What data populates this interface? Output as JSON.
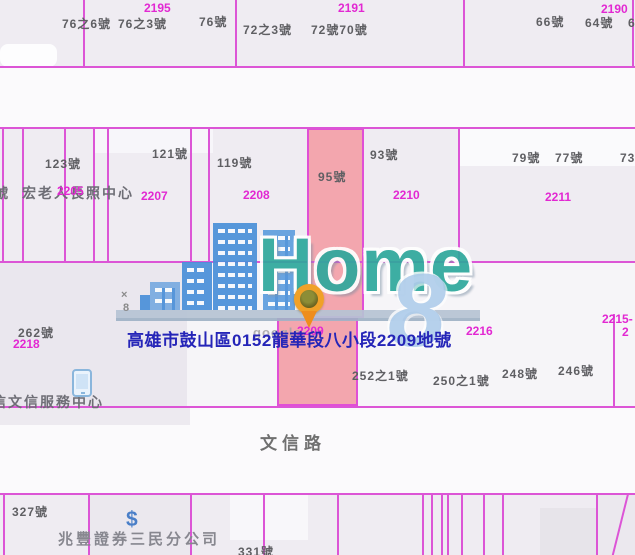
{
  "watermark": {
    "brand": "Home",
    "badge": "8"
  },
  "map": {
    "background": "#efecf2",
    "boundary_color": "#dc55d6",
    "highlight_fill": "#f3a6ae",
    "address_text": "高雄市鼓山區0152龍華段八小段2209地號",
    "road_name": "文信路",
    "highlighted_parcel_number": "2209",
    "regions": [
      {
        "x": 0,
        "y": 66,
        "w": 635,
        "h": 61,
        "c": "#fbfafc",
        "n": "road-area-top"
      },
      {
        "x": 0,
        "y": 261,
        "w": 635,
        "h": 146,
        "c": "#f6f5f8",
        "n": "block-middle"
      },
      {
        "x": 0,
        "y": 261,
        "w": 187,
        "h": 146,
        "c": "#eae7ee",
        "n": "block-middle-left"
      },
      {
        "x": 0,
        "y": 407,
        "w": 635,
        "h": 86,
        "c": "#fbfafc",
        "n": "road-area-wenxin"
      },
      {
        "x": 0,
        "y": 407,
        "w": 190,
        "h": 18,
        "c": "#edeaf0",
        "n": "strip-left"
      },
      {
        "x": 95,
        "y": 129,
        "w": 118,
        "h": 24,
        "c": "#f7f6fa",
        "n": "building-footprint"
      },
      {
        "x": 459,
        "y": 128,
        "w": 176,
        "h": 38,
        "c": "#fafafc",
        "n": "building-footprint"
      },
      {
        "x": 0,
        "y": 44,
        "w": 57,
        "h": 23,
        "c": "#fdfdfe",
        "r": 8,
        "n": "building-footprint"
      },
      {
        "x": 230,
        "y": 495,
        "w": 78,
        "h": 45,
        "c": "#f8f7fa",
        "n": "building-footprint"
      },
      {
        "x": 540,
        "y": 508,
        "w": 80,
        "h": 47,
        "c": "#e7e4ea",
        "n": "building-footprint"
      },
      {
        "x": 88,
        "y": 495,
        "w": 102,
        "h": 60,
        "c": "#ebe8ee",
        "n": "building-footprint"
      },
      {
        "x": 596,
        "y": 495,
        "w": 39,
        "h": 60,
        "c": "#ebe8ee",
        "n": "building-footprint"
      }
    ],
    "highlight_parcels": [
      {
        "x": 307,
        "y": 128,
        "w": 57,
        "h": 190,
        "n": "highlighted-parcel-upper"
      },
      {
        "x": 277,
        "y": 318,
        "w": 81,
        "h": 88,
        "n": "highlighted-parcel-lower"
      }
    ],
    "boundaries": [
      {
        "x": 0,
        "y": 66,
        "w": 635,
        "h": 2
      },
      {
        "x": 0,
        "y": 127,
        "w": 635,
        "h": 2
      },
      {
        "x": 0,
        "y": 261,
        "w": 635,
        "h": 2
      },
      {
        "x": 0,
        "y": 406,
        "w": 635,
        "h": 2
      },
      {
        "x": 0,
        "y": 493,
        "w": 635,
        "h": 2
      },
      {
        "x": 83,
        "y": 0,
        "w": 2,
        "h": 67
      },
      {
        "x": 235,
        "y": 0,
        "w": 2,
        "h": 67
      },
      {
        "x": 463,
        "y": 0,
        "w": 2,
        "h": 67
      },
      {
        "x": 632,
        "y": 0,
        "w": 2,
        "h": 67
      },
      {
        "x": 2,
        "y": 128,
        "w": 2,
        "h": 134
      },
      {
        "x": 22,
        "y": 128,
        "w": 2,
        "h": 134
      },
      {
        "x": 64,
        "y": 128,
        "w": 2,
        "h": 134
      },
      {
        "x": 93,
        "y": 128,
        "w": 2,
        "h": 134
      },
      {
        "x": 107,
        "y": 128,
        "w": 2,
        "h": 134
      },
      {
        "x": 190,
        "y": 128,
        "w": 2,
        "h": 134
      },
      {
        "x": 208,
        "y": 128,
        "w": 2,
        "h": 134
      },
      {
        "x": 458,
        "y": 128,
        "w": 2,
        "h": 134
      },
      {
        "x": 613,
        "y": 314,
        "w": 2,
        "h": 93
      },
      {
        "x": 3,
        "y": 494,
        "w": 2,
        "h": 61
      },
      {
        "x": 88,
        "y": 494,
        "w": 2,
        "h": 61
      },
      {
        "x": 190,
        "y": 494,
        "w": 2,
        "h": 61
      },
      {
        "x": 263,
        "y": 494,
        "w": 2,
        "h": 61
      },
      {
        "x": 337,
        "y": 494,
        "w": 2,
        "h": 61
      },
      {
        "x": 422,
        "y": 494,
        "w": 2,
        "h": 61
      },
      {
        "x": 431,
        "y": 494,
        "w": 2,
        "h": 61
      },
      {
        "x": 441,
        "y": 494,
        "w": 2,
        "h": 61
      },
      {
        "x": 447,
        "y": 494,
        "w": 2,
        "h": 61
      },
      {
        "x": 461,
        "y": 494,
        "w": 2,
        "h": 61
      },
      {
        "x": 483,
        "y": 494,
        "w": 2,
        "h": 61
      },
      {
        "x": 502,
        "y": 494,
        "w": 2,
        "h": 61
      },
      {
        "x": 596,
        "y": 494,
        "w": 2,
        "h": 61
      },
      {
        "x": 627,
        "y": 494,
        "w": 2,
        "h": 64,
        "rot": 14
      }
    ],
    "labels": [
      {
        "t": "76之6號",
        "x": 62,
        "y": 18,
        "cls": "h",
        "n": "house-number-label"
      },
      {
        "t": "76之3號",
        "x": 118,
        "y": 18,
        "cls": "h",
        "n": "house-number-label"
      },
      {
        "t": "76號",
        "x": 199,
        "y": 16,
        "cls": "h",
        "n": "house-number-label"
      },
      {
        "t": "72之3號",
        "x": 243,
        "y": 24,
        "cls": "h",
        "n": "house-number-label"
      },
      {
        "t": "72號70號",
        "x": 311,
        "y": 24,
        "cls": "h",
        "n": "house-number-label"
      },
      {
        "t": "66號",
        "x": 536,
        "y": 16,
        "cls": "h",
        "n": "house-number-label"
      },
      {
        "t": "64號",
        "x": 585,
        "y": 17,
        "cls": "h",
        "n": "house-number-label"
      },
      {
        "t": "62號",
        "x": 628,
        "y": 17,
        "cls": "h",
        "n": "house-number-label"
      },
      {
        "t": "2195",
        "x": 144,
        "y": 2,
        "cls": "p",
        "n": "parcel-number-label"
      },
      {
        "t": "2191",
        "x": 338,
        "y": 2,
        "cls": "p",
        "n": "parcel-number-label"
      },
      {
        "t": "2190",
        "x": 601,
        "y": 3,
        "cls": "p",
        "n": "parcel-number-label"
      },
      {
        "t": "123號",
        "x": 45,
        "y": 158,
        "cls": "h",
        "n": "house-number-label"
      },
      {
        "t": "121號",
        "x": 152,
        "y": 148,
        "cls": "h",
        "n": "house-number-label"
      },
      {
        "t": "119號",
        "x": 217,
        "y": 157,
        "cls": "h",
        "n": "house-number-label"
      },
      {
        "t": "95號",
        "x": 318,
        "y": 171,
        "cls": "h",
        "n": "house-number-label"
      },
      {
        "t": "93號",
        "x": 370,
        "y": 149,
        "cls": "h",
        "n": "house-number-label"
      },
      {
        "t": "79號",
        "x": 512,
        "y": 152,
        "cls": "h",
        "n": "house-number-label"
      },
      {
        "t": "77號",
        "x": 555,
        "y": 152,
        "cls": "h",
        "n": "house-number-label"
      },
      {
        "t": "73號",
        "x": 620,
        "y": 152,
        "cls": "h",
        "n": "house-number-label"
      },
      {
        "t": "號",
        "x": -6,
        "y": 186,
        "cls": "poi",
        "n": "poi-label"
      },
      {
        "t": "宏老人長照中心",
        "x": 22,
        "y": 186,
        "cls": "poi",
        "n": "poi-label"
      },
      {
        "t": "2205",
        "x": 57,
        "y": 185,
        "cls": "p",
        "n": "parcel-number-label"
      },
      {
        "t": "2207",
        "x": 141,
        "y": 190,
        "cls": "p",
        "n": "parcel-number-label"
      },
      {
        "t": "2208",
        "x": 243,
        "y": 189,
        "cls": "p",
        "n": "parcel-number-label"
      },
      {
        "t": "2210",
        "x": 393,
        "y": 189,
        "cls": "p",
        "n": "parcel-number-label"
      },
      {
        "t": "2211",
        "x": 545,
        "y": 191,
        "cls": "p",
        "n": "parcel-number-label"
      },
      {
        "t": "×",
        "x": 121,
        "y": 289,
        "cls": "tiny",
        "n": "map-annotation"
      },
      {
        "t": "8",
        "x": 123,
        "y": 302,
        "cls": "tiny",
        "n": "map-annotation"
      },
      {
        "t": "262號",
        "x": 18,
        "y": 327,
        "cls": "h",
        "n": "house-number-label"
      },
      {
        "t": "2218",
        "x": 13,
        "y": 338,
        "cls": "p",
        "n": "parcel-number-label"
      },
      {
        "t": "google",
        "x": 253,
        "y": 326,
        "cls": "google",
        "n": "attribution-label"
      },
      {
        "t": "2209",
        "x": 297,
        "y": 325,
        "cls": "p",
        "n": "parcel-number-label"
      },
      {
        "t": "2216",
        "x": 466,
        "y": 325,
        "cls": "p",
        "n": "parcel-number-label"
      },
      {
        "t": "2215-",
        "x": 602,
        "y": 313,
        "cls": "p",
        "n": "parcel-number-label"
      },
      {
        "t": "2",
        "x": 622,
        "y": 326,
        "cls": "p",
        "n": "parcel-number-label"
      },
      {
        "t": "高雄市鼓山區0152龍華段八小段2209地號",
        "x": 127,
        "y": 332,
        "cls": "addr",
        "n": "parcel-address-label"
      },
      {
        "t": "252之1號",
        "x": 352,
        "y": 370,
        "cls": "h",
        "n": "house-number-label"
      },
      {
        "t": "250之1號",
        "x": 433,
        "y": 375,
        "cls": "h",
        "n": "house-number-label"
      },
      {
        "t": "248號",
        "x": 502,
        "y": 368,
        "cls": "h",
        "n": "house-number-label"
      },
      {
        "t": "246號",
        "x": 558,
        "y": 365,
        "cls": "h",
        "n": "house-number-label"
      },
      {
        "t": "信文信服務中心",
        "x": -8,
        "y": 395,
        "cls": "poi",
        "n": "poi-label"
      },
      {
        "t": "文信路",
        "x": 260,
        "y": 435,
        "cls": "road",
        "n": "road-name-label"
      },
      {
        "t": "327號",
        "x": 12,
        "y": 506,
        "cls": "h",
        "n": "house-number-label"
      },
      {
        "t": "$",
        "x": 126,
        "y": 508,
        "cls": "dollar",
        "n": "bank-icon"
      },
      {
        "t": "兆豐證券三民分公司",
        "x": 58,
        "y": 532,
        "cls": "biz",
        "n": "poi-label"
      },
      {
        "t": "331號",
        "x": 238,
        "y": 546,
        "cls": "h",
        "n": "house-number-label"
      }
    ]
  }
}
